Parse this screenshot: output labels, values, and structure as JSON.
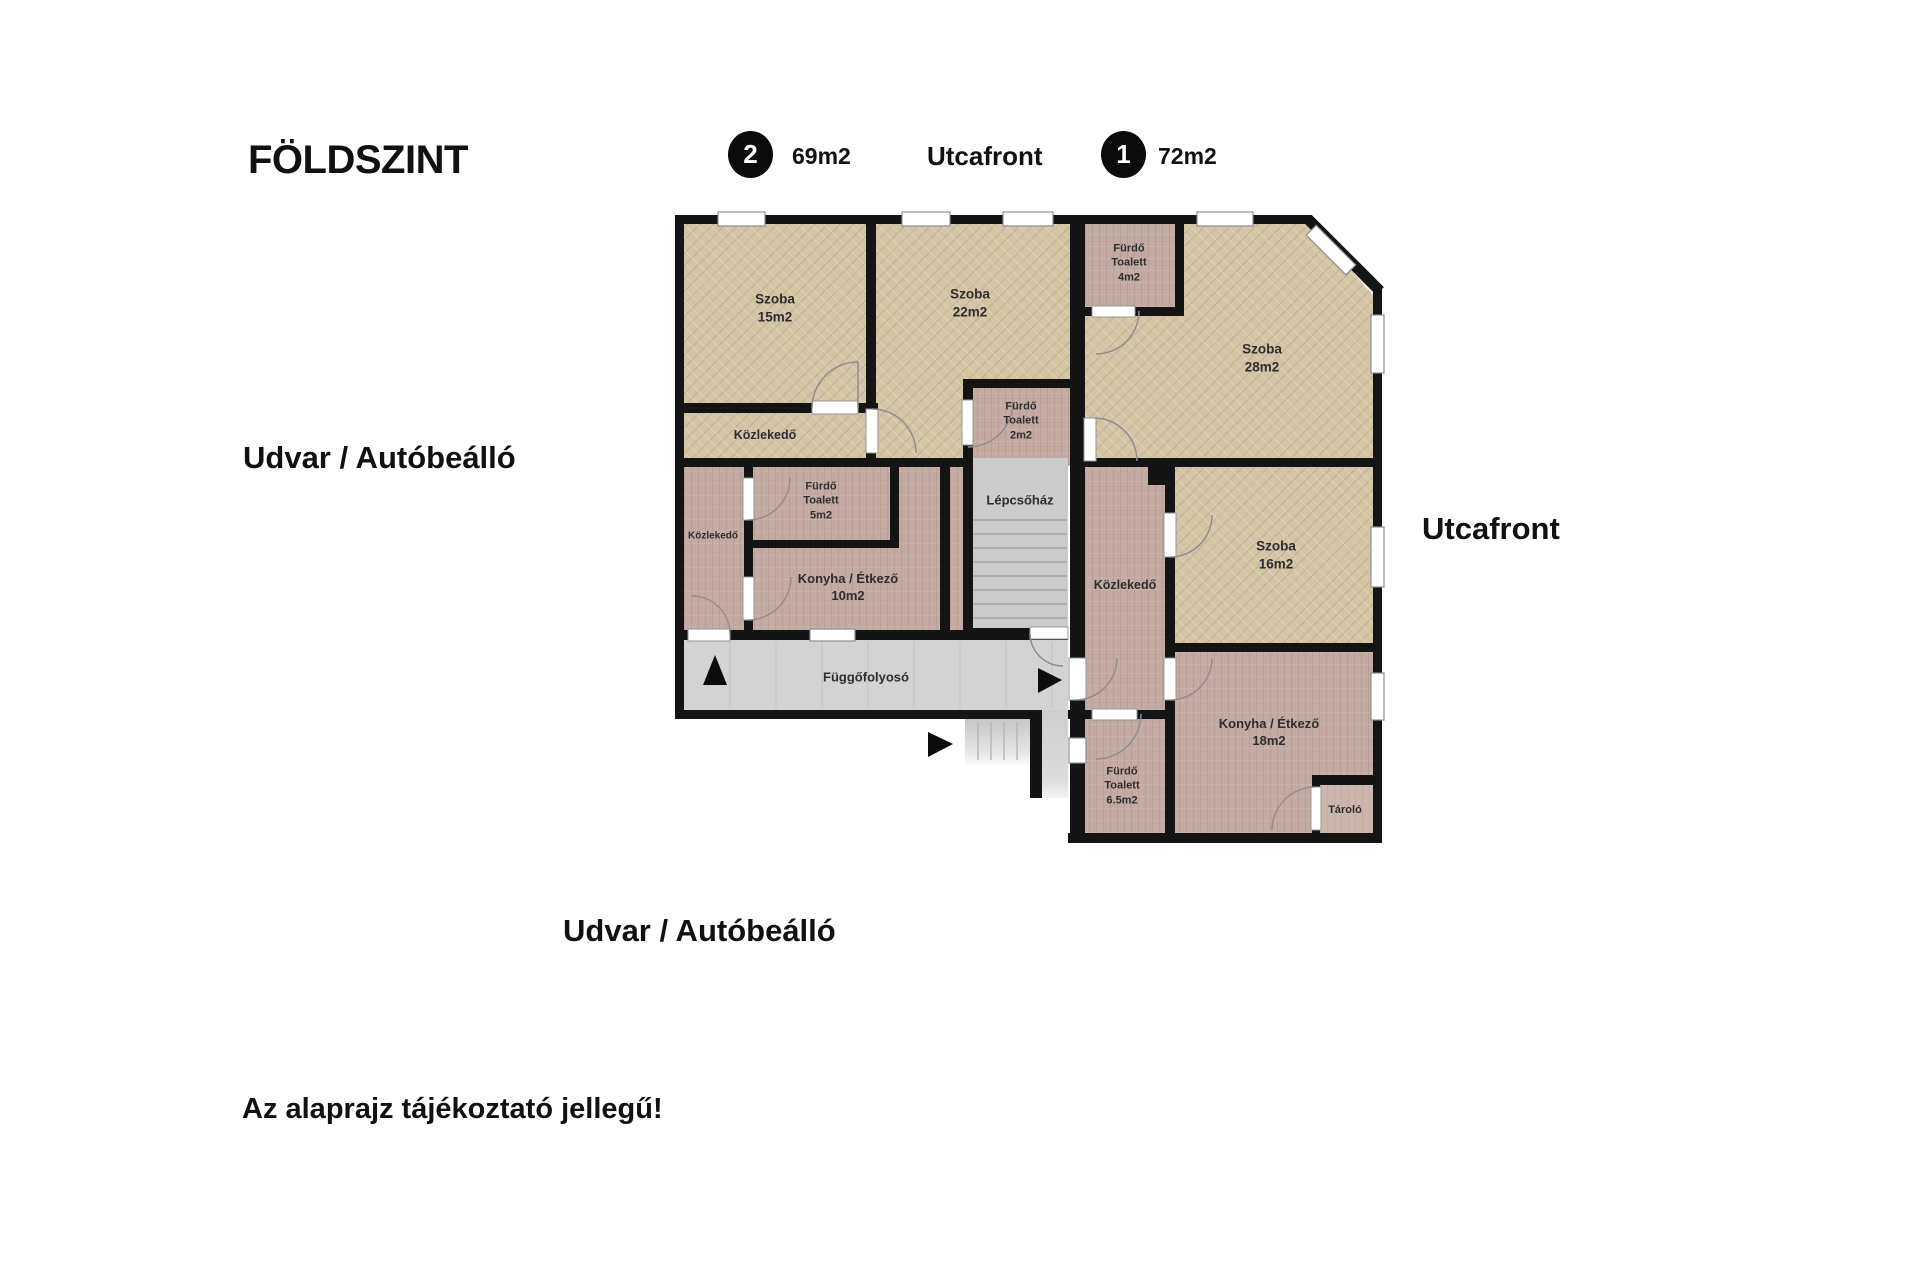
{
  "header": {
    "floor_title": "FÖLDSZINT",
    "street_top": "Utcafront",
    "unit2": {
      "number": "2",
      "area": "69m2"
    },
    "unit1": {
      "number": "1",
      "area": "72m2"
    }
  },
  "surroundings": {
    "left": "Udvar / Autóbeálló",
    "right": "Utcafront",
    "bottom": "Udvar / Autóbeálló"
  },
  "disclaimer": "Az alaprajz tájékoztató jellegű!",
  "rooms": {
    "szoba15": {
      "line1": "Szoba",
      "area": "15m2"
    },
    "szoba22": {
      "line1": "Szoba",
      "area": "22m2"
    },
    "furdo4": {
      "line1": "Fürdő",
      "line2": "Toalett",
      "area": "4m2"
    },
    "szoba28": {
      "line1": "Szoba",
      "area": "28m2"
    },
    "kozlekedo_tan": {
      "line1": "Közlekedő"
    },
    "furdo2": {
      "line1": "Fürdő",
      "line2": "Toalett",
      "area": "2m2"
    },
    "lepcsohaz": {
      "line1": "Lépcsőház"
    },
    "kozlekedo_left": {
      "line1": "Közlekedő"
    },
    "furdo5": {
      "line1": "Fürdő",
      "line2": "Toalett",
      "area": "5m2"
    },
    "konyha10": {
      "line1": "Konyha / Étkező",
      "area": "10m2"
    },
    "kozlekedo_right": {
      "line1": "Közlekedő"
    },
    "szoba16": {
      "line1": "Szoba",
      "area": "16m2"
    },
    "fuggofolyoso": {
      "line1": "Függőfolyosó"
    },
    "furdo65": {
      "line1": "Fürdő",
      "line2": "Toalett",
      "area": "6.5m2"
    },
    "konyha18": {
      "line1": "Konyha / Étkező",
      "area": "18m2"
    },
    "tarolo": {
      "line1": "Tároló"
    }
  },
  "colors": {
    "wall": "#141414",
    "room_wood": "#d3c5a4",
    "service_wood": "#c3aba4",
    "stair_gray": "#cbcbcb",
    "badge_bg": "#0b0b0b"
  }
}
